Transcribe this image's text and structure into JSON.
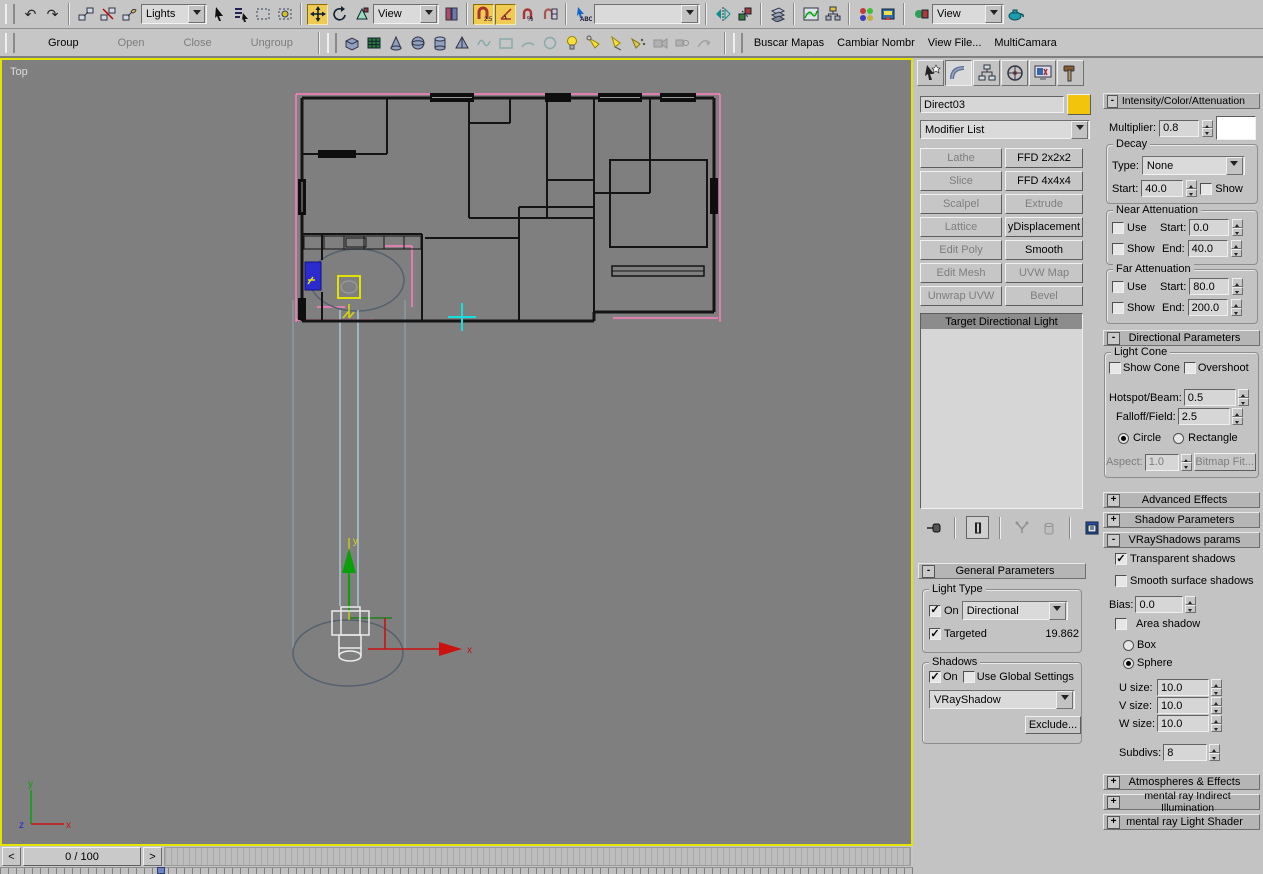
{
  "toolbar": {
    "lights_dropdown": "Lights",
    "ref_coord_dropdown": "View",
    "named_selection_dropdown": "",
    "render_view_dropdown": "View",
    "undo_glyph": "↶",
    "redo_glyph": "↷"
  },
  "group_toolbar": {
    "group": "Group",
    "open": "Open",
    "close": "Close",
    "ungroup": "Ungroup"
  },
  "custom_buttons": {
    "buscar": "Buscar Mapas",
    "cambiar": "Cambiar Nombr",
    "viewfile": "View File...",
    "multicamara": "MultiCamara"
  },
  "viewport": {
    "label": "Top",
    "axis_x": "x",
    "axis_y": "y",
    "axis_z": "z",
    "gizmo_x": "x",
    "gizmo_y": "y"
  },
  "timeline": {
    "frame": "0 / 100",
    "prev": "<",
    "next": ">"
  },
  "ui": {
    "plus": "+",
    "minus": "-"
  },
  "panel": {
    "name_field": "Direct03",
    "modifier_list": "Modifier List",
    "modifiers": [
      {
        "label": "Lathe",
        "enabled": false
      },
      {
        "label": "FFD 2x2x2",
        "enabled": true
      },
      {
        "label": "Slice",
        "enabled": false
      },
      {
        "label": "FFD 4x4x4",
        "enabled": true
      },
      {
        "label": "Scalpel",
        "enabled": false
      },
      {
        "label": "Extrude",
        "enabled": false
      },
      {
        "label": "Lattice",
        "enabled": false
      },
      {
        "label": "yDisplacement",
        "enabled": true
      },
      {
        "label": "Edit Poly",
        "enabled": false
      },
      {
        "label": "Smooth",
        "enabled": true
      },
      {
        "label": "Edit Mesh",
        "enabled": false
      },
      {
        "label": "UVW Map",
        "enabled": false
      },
      {
        "label": "Unwrap UVW",
        "enabled": false
      },
      {
        "label": "Bevel",
        "enabled": false
      }
    ],
    "stack_selected": "Target Directional Light",
    "general_parameters": {
      "title": "General Parameters",
      "light_type_label": "Light Type",
      "on_label": "On",
      "type_value": "Directional",
      "targeted_label": "Targeted",
      "targeted_value": "19.862",
      "shadows_label": "Shadows",
      "shadow_on_label": "On",
      "use_global_label": "Use Global Settings",
      "shadow_plugin": "VRayShadow",
      "exclude_label": "Exclude..."
    },
    "intensity": {
      "title": "Intensity/Color/Attenuation",
      "multiplier_label": "Multiplier:",
      "multiplier_value": "0.8",
      "decay_label": "Decay",
      "type_label": "Type:",
      "type_value": "None",
      "start_label": "Start:",
      "start_value": "40.0",
      "show_label": "Show",
      "near": {
        "title": "Near Attenuation",
        "use": "Use",
        "show": "Show",
        "start_label": "Start:",
        "start": "0.0",
        "end_label": "End:",
        "end": "40.0"
      },
      "far": {
        "title": "Far Attenuation",
        "use": "Use",
        "show": "Show",
        "start_label": "Start:",
        "start": "80.0",
        "end_label": "End:",
        "end": "200.0"
      }
    },
    "directional": {
      "title": "Directional Parameters",
      "light_cone": "Light Cone",
      "show_cone": "Show Cone",
      "overshoot": "Overshoot",
      "hotspot_label": "Hotspot/Beam:",
      "hotspot": "0.5",
      "falloff_label": "Falloff/Field:",
      "falloff": "2.5",
      "circle": "Circle",
      "rectangle": "Rectangle",
      "aspect_label": "Aspect:",
      "aspect": "1.0",
      "bitmap_fit": "Bitmap Fit..."
    },
    "rollouts": {
      "advanced_effects": "Advanced Effects",
      "shadow_parameters": "Shadow Parameters",
      "vray_params": "VRayShadows params",
      "atmospheres": "Atmospheres & Effects",
      "mr_indirect": "mental ray Indirect Illumination",
      "mr_shader": "mental ray Light Shader"
    },
    "vray": {
      "transparent": "Transparent shadows",
      "smooth": "Smooth surface shadows",
      "bias_label": "Bias:",
      "bias": "0.0",
      "area_shadow": "Area shadow",
      "box": "Box",
      "sphere": "Sphere",
      "u_label": "U size:",
      "u": "10.0",
      "v_label": "V size:",
      "v": "10.0",
      "w_label": "W size:",
      "w": "10.0",
      "subdivs_label": "Subdivs:",
      "subdivs": "8"
    }
  },
  "colors": {
    "object_color_swatch": "#f2c50c",
    "light_color_swatch": "#ffffff",
    "viewport_border": "#e4e400",
    "selection_pink": "#ff7fbf",
    "beam_blue": "#aed2e4",
    "viewport_bg": "#7f7f7f"
  }
}
